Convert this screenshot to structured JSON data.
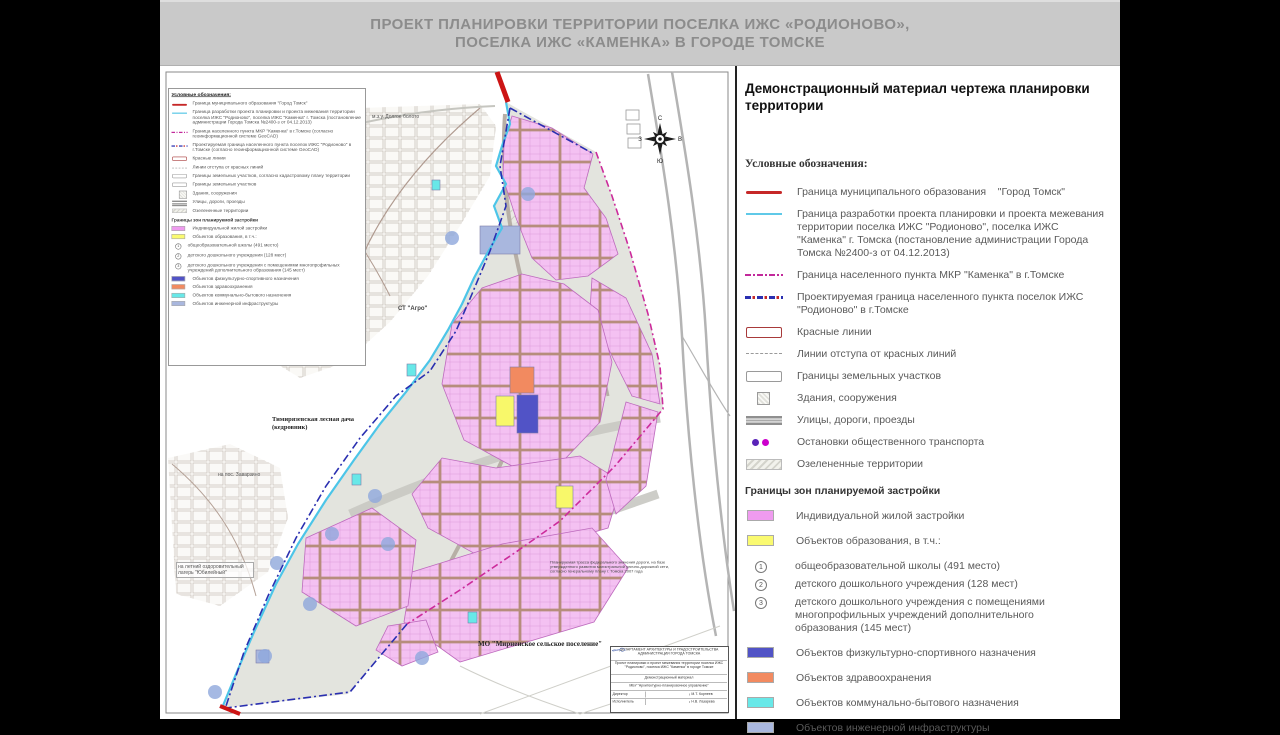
{
  "header": {
    "line1": "ПРОЕКТ ПЛАНИРОВКИ  ТЕРРИТОРИИ ПОСЕЛКА ИЖС «РОДИОНОВО»,",
    "line2": "ПОСЕЛКА ИЖС «КАМЕНКА» В ГОРОДЕ ТОМСКЕ"
  },
  "panel": {
    "title": "Демонстрационный материал чертежа планировки территории",
    "legend_heading": "Условные обозначения:",
    "lines": [
      {
        "type": "red-solid",
        "label": "Граница муниципального образования    \"Город Томск\""
      },
      {
        "type": "cyan-solid",
        "label": "Граница разработки проекта планировки и проекта межевания территории поселка ИЖС \"Родионово\", поселка ИЖС \"Каменка\" г. Томска (постановление администрации Города Томска  №2400-з от 04.12.2013)"
      },
      {
        "type": "mag-dd",
        "label": "Граница населенного пункта МКР  \"Каменка\" в г.Томске"
      },
      {
        "type": "blue-dd",
        "label": "Проектируемая граница населенного пункта поселок ИЖС  \"Родионово\" в г.Томске"
      }
    ],
    "symbols": [
      {
        "type": "red-rect",
        "label": "Красные линии"
      },
      {
        "type": "dash",
        "label": "Линии отступа от красных линий"
      },
      {
        "type": "rect",
        "label": "Границы земельных участков"
      },
      {
        "type": "bld",
        "label": "Здания, сооружения"
      },
      {
        "type": "road",
        "label": "Улицы, дороги, проезды"
      },
      {
        "type": "dots",
        "label": "Остановки общественного транспорта"
      },
      {
        "type": "hatch",
        "label": "Озелененные территории"
      }
    ],
    "zones_heading": "Границы зон планируемой застройки",
    "zones1": [
      {
        "color": "#ef9bef",
        "label": "Индивидуальной жилой застройки"
      },
      {
        "color": "#fafa70",
        "label": "Объектов образования, в т.ч.:"
      }
    ],
    "education": [
      {
        "num": "1",
        "label": "общеобразовательной школы (491 место)"
      },
      {
        "num": "2",
        "label": "детского дошкольного учреждения (128 мест)"
      },
      {
        "num": "3",
        "label": "детского дошкольного учреждения с помещениями многопрофильных учреждений дополнительного образования (145 мест)"
      }
    ],
    "zones2": [
      {
        "color": "#5153c6",
        "label": "Объектов физкультурно-спортивного назначения"
      },
      {
        "color": "#f28a60",
        "label": "Объектов здравоохранения"
      },
      {
        "color": "#68e8e8",
        "label": "Объектов коммунально-бытового назначения"
      },
      {
        "color": "#a9b7de",
        "label": "Объектов инженерной инфраструктуры"
      }
    ]
  },
  "map": {
    "legend": {
      "title": "Условные обозначения:",
      "lines": [
        {
          "type": "red-solid",
          "label": "Граница муниципального образования  \"Город Томск\""
        },
        {
          "type": "cyan-solid",
          "label": "Граница разработки проекта планировки и проекта межевания территории поселка ИЖС \"Родионово\", поселка ИЖС \"Каменка\" г. Томска (постановление администрации Города Томска №2400-з от 04.12.2013)"
        },
        {
          "type": "mag-dd",
          "label": "Граница населенного пункта МКР \"Каменка\" в г.Томске (согласно геоинформационной системе GeoCAD)"
        },
        {
          "type": "blue-dd",
          "label": "Проектируемая граница населенного пункта поселок ИЖС \"Родионово\" в г.Томске (согласно геоинформационной системе GeoCAD)"
        }
      ],
      "symbols": [
        {
          "type": "red-rect",
          "label": "Красные линии"
        },
        {
          "type": "dash",
          "label": "Линии отступа от красных линий"
        },
        {
          "type": "rect",
          "label": "Границы земельных участков, согласно кадастровому плану территории"
        },
        {
          "type": "rect",
          "label": "Границы земельных участков"
        },
        {
          "type": "bld",
          "label": "Здания, сооружения"
        },
        {
          "type": "road",
          "label": "Улицы, дороги, проезды"
        },
        {
          "type": "hatch",
          "label": "Озелененные территории"
        }
      ]
    },
    "labels": {
      "bog": "м.з.у. Долгое болото",
      "agro": "СТ \"Агро\"",
      "dacha1": "Тимирязевская лесная дача",
      "dacha2": "(кедровник)",
      "zavarzino": "на пос. Заварзино",
      "camp1": "на летний оздоровительный",
      "camp2": "лагерь \"Юбилейный\"",
      "mo": "МО \"Мирненское сельское поселение\"",
      "note": "Планируемая трасса федерального значения дороги, на базе утвержденного развития магистральной улично-дорожной сети, согласно генеральному плану г. Томска 2007 года"
    },
    "compass": {
      "n": "С",
      "s": "Ю",
      "w": "З",
      "e": "В"
    },
    "stamp": {
      "org": "ДЕПАРТАМЕНТ АРХИТЕКТУРЫ И ГРАДОСТРОИТЕЛЬСТВА АДМИНИСТРАЦИИ ГОРОДА ТОМСКА",
      "project": "Проект планировки и проект межевания территории поселка ИЖС \"Родионово\", поселка ИЖС \"Каменка\" в городе Томске",
      "doc": "Демонстрационный материал",
      "office": "МБУ \"Архитектурно-планировочное управление\"",
      "role1": "Директор",
      "name1": "М.Т. Корнеев",
      "role2": "Исполнитель",
      "name2": "Н.В. Лазарева"
    }
  },
  "colors": {
    "municipal_boundary": "#c62828",
    "project_boundary": "#5fc9e8",
    "kamenka_boundary": "#c2299b",
    "rodionovo_boundary": "#2a2fb0",
    "residential": "#ef9bef",
    "education": "#fafa70",
    "sport": "#5153c6",
    "health": "#f28a60",
    "communal": "#68e8e8",
    "engineering": "#a9b7de"
  }
}
